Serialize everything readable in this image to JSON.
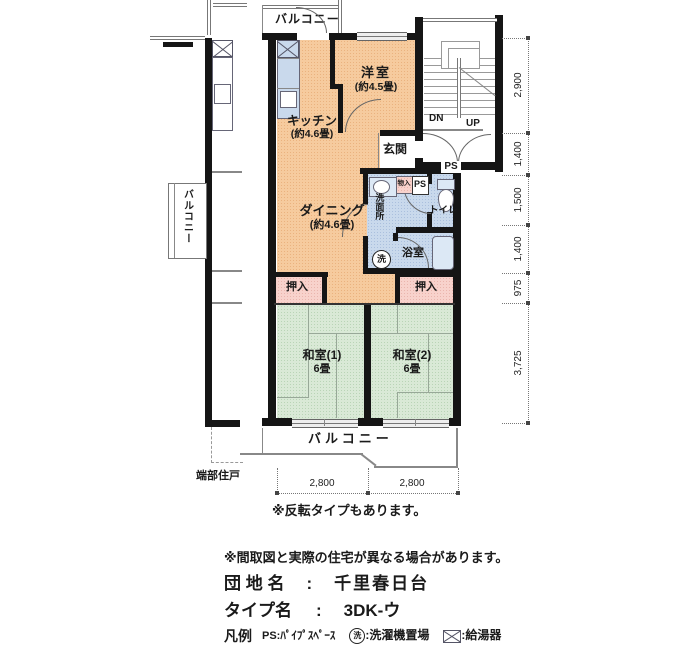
{
  "plan": {
    "balcony_top": "バルコニー",
    "balcony_left": "バルコニー",
    "balcony_bottom": "バルコニー",
    "rooms": {
      "yoshitsu": {
        "name": "洋室",
        "size": "(約4.5畳)"
      },
      "kitchen": {
        "name": "キッチン",
        "size": "(約4.6畳)"
      },
      "dining": {
        "name": "ダイニング",
        "size": "(約4.6畳)"
      },
      "genkan": "玄関",
      "senmenjo": "洗面所",
      "toilet": "トイレ",
      "bath": "浴室",
      "monoire": "物入",
      "ps_closet": "PS",
      "oshiire_left": "押入",
      "oshiire_right": "押入",
      "washitsu1": {
        "name": "和室(1)",
        "size": "6畳"
      },
      "washitsu2": {
        "name": "和室(2)",
        "size": "6畳"
      },
      "laundry": "洗"
    },
    "stairs": {
      "dn": "DN",
      "up": "UP",
      "ps": "PS"
    },
    "neighbor": "端部住戸",
    "dims": {
      "right": [
        "2,900",
        "1,400",
        "1,500",
        "1,400",
        "975",
        "3,725"
      ],
      "bottom": [
        "2,800",
        "2,800"
      ]
    }
  },
  "notes": {
    "reverse": "※反転タイプもあります。",
    "disclaimer": "※間取図と実際の住宅が異なる場合があります。"
  },
  "info": {
    "estate_label": "団 地 名",
    "colon": ":",
    "estate_value": "千里春日台",
    "type_label": "タイプ名",
    "type_value": "3DK-ウ"
  },
  "legend": {
    "title": "凡例",
    "ps": "PS:ﾊﾟｲﾌﾟｽﾍﾟｰｽ",
    "laundry_symbol": "洗",
    "laundry_text": ":洗濯機置場",
    "heater_text": ":給湯器"
  },
  "colors": {
    "floor_ldk": "#f6cb9e",
    "floor_wet": "#c9d9ec",
    "floor_tatami": "#d9e9d6",
    "floor_closet": "#f8d2cc",
    "wall": "#151515"
  }
}
